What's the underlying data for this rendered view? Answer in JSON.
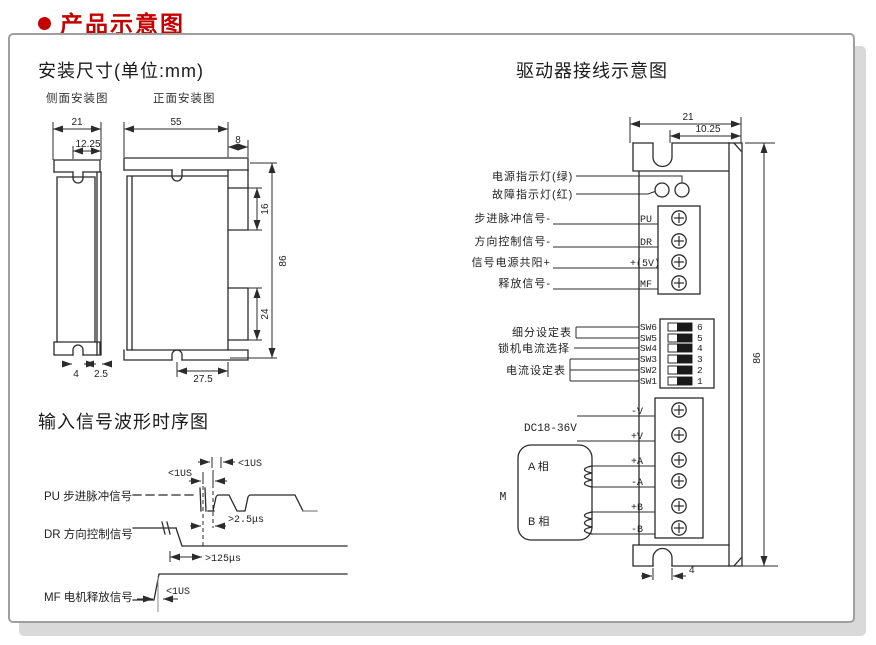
{
  "header": {
    "title": "产品示意图"
  },
  "install": {
    "title": "安装尺寸(单位:mm)",
    "side_view_label": "侧面安装图",
    "front_view_label": "正面安装图",
    "dims": {
      "side_width": "21",
      "side_slot": "12.25",
      "side_slot_width": "4",
      "side_plate": "2.5",
      "front_width": "55",
      "front_tab_width": "8",
      "front_tab_top": "16",
      "front_height": "86",
      "front_tab_bottom": "24",
      "front_slot_offset": "27.5"
    }
  },
  "waveform": {
    "title": "输入信号波形时序图",
    "pu_label": "PU 步进脉冲信号",
    "dr_label": "DR 方向控制信号",
    "mf_label": "MF 电机释放信号",
    "ann_pulse_width": "<1US",
    "ann_pulse_gap": "<1US",
    "ann_dir_setup": ">2.5μs",
    "ann_dir_hold": ">125μs",
    "ann_mf": "<1US"
  },
  "wiring": {
    "title": "驱动器接线示意图",
    "led_green_label": "电源指示灯(绿)",
    "led_red_label": "故障指示灯(红)",
    "signal_rows": [
      {
        "label": "步进脉冲信号-",
        "pin": "PU"
      },
      {
        "label": "方向控制信号-",
        "pin": "DR"
      },
      {
        "label": "信号电源共阳+",
        "pin": "+(5V)"
      },
      {
        "label": "释放信号-",
        "pin": "MF"
      }
    ],
    "dip": {
      "subdivision_label": "细分设定表",
      "lock_current_label": "锁机电流选择",
      "current_label": "电流设定表",
      "switches": [
        {
          "name": "SW6",
          "num": "6"
        },
        {
          "name": "SW5",
          "num": "5"
        },
        {
          "name": "SW4",
          "num": "4"
        },
        {
          "name": "SW3",
          "num": "3"
        },
        {
          "name": "SW2",
          "num": "2"
        },
        {
          "name": "SW1",
          "num": "1"
        }
      ]
    },
    "power_label": "DC18-36V",
    "power_rows": [
      {
        "pin": "-V"
      },
      {
        "pin": "+V"
      },
      {
        "pin": "+A"
      },
      {
        "pin": "-A"
      },
      {
        "pin": "+B"
      },
      {
        "pin": "-B"
      }
    ],
    "motor": {
      "label": "M",
      "phase_a": "A 相",
      "phase_b": "B 相"
    },
    "dims": {
      "width": "21",
      "notch_offset": "10.25",
      "height": "86",
      "slot_width": "4"
    }
  },
  "colors": {
    "accent": "#c40000",
    "line": "#2b2b2b",
    "shadow": "#d9d9d9"
  }
}
